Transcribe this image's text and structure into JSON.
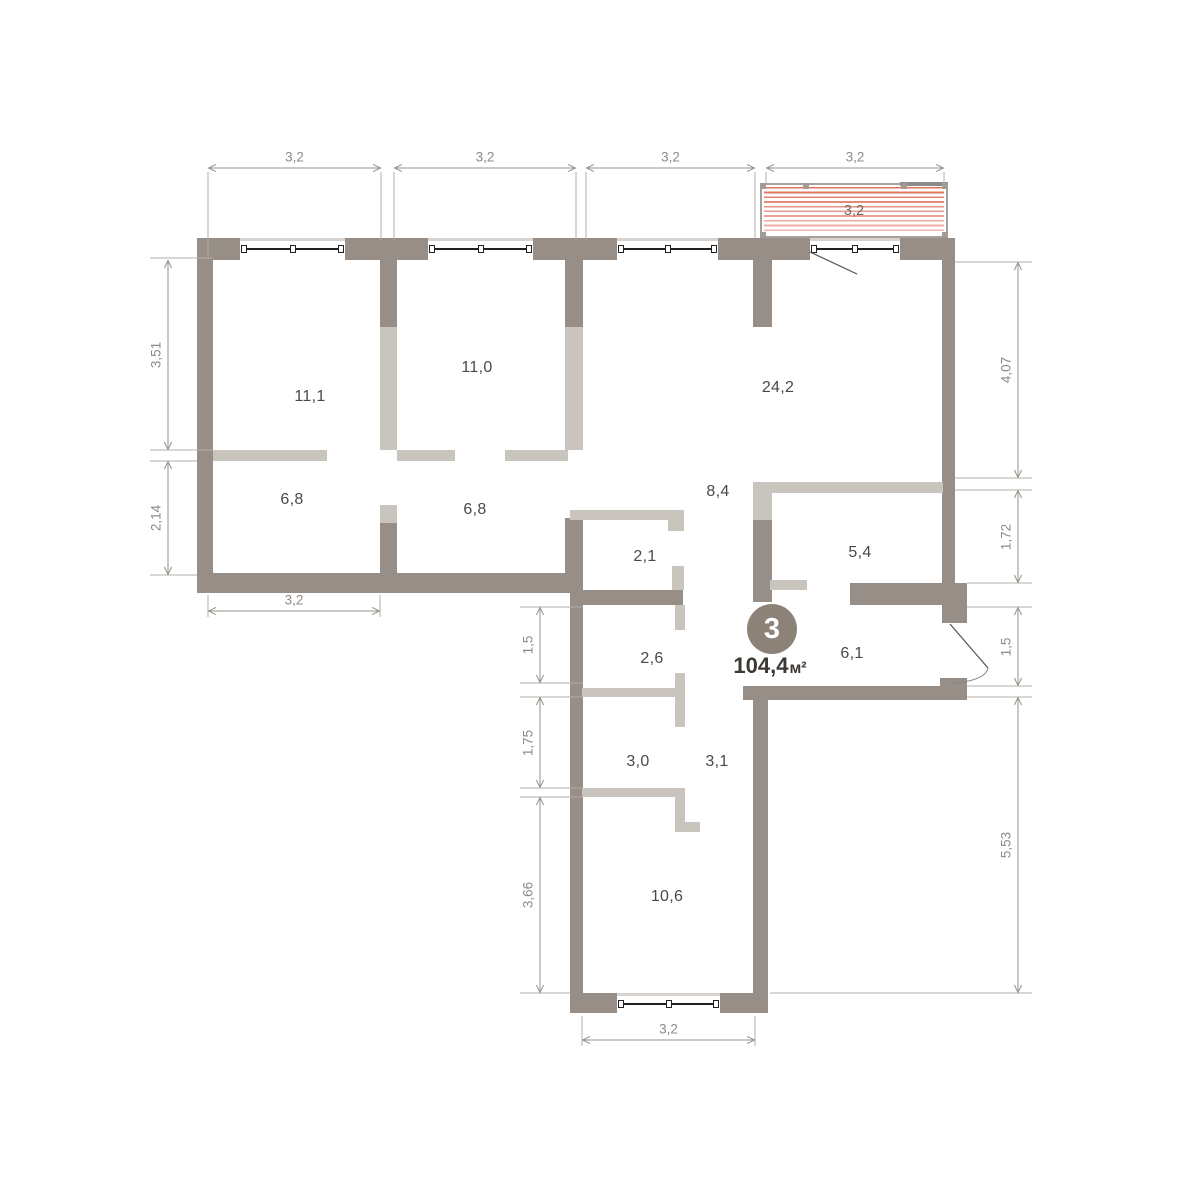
{
  "unit": {
    "badge_number": "3",
    "area_value": "104,4",
    "area_unit": "м²"
  },
  "plan": {
    "canvas": {
      "w": 1177,
      "h": 1200,
      "bg": "#ffffff"
    },
    "colors": {
      "wall_dark": "#978f87",
      "wall_light": "#c9c4be",
      "dim_line": "#97928c",
      "dim_text": "#8f8a84",
      "ext_line": "#b3aea8",
      "room_text": "#4b4945",
      "window_line": "#23211f",
      "balcony_stripe": "#e0705b",
      "balcony_frame": "#a7a19b",
      "badge_fill": "#8c8278",
      "door_line": "#55514d"
    },
    "rooms": [
      {
        "area": "11,1",
        "x": 310,
        "y": 397
      },
      {
        "area": "11,0",
        "x": 477,
        "y": 368
      },
      {
        "area": "24,2",
        "x": 778,
        "y": 388
      },
      {
        "area": "6,8",
        "x": 292,
        "y": 500
      },
      {
        "area": "6,8",
        "x": 475,
        "y": 510
      },
      {
        "area": "8,4",
        "x": 718,
        "y": 492
      },
      {
        "area": "2,1",
        "x": 645,
        "y": 557
      },
      {
        "area": "5,4",
        "x": 860,
        "y": 553
      },
      {
        "area": "2,6",
        "x": 652,
        "y": 659
      },
      {
        "area": "6,1",
        "x": 852,
        "y": 654
      },
      {
        "area": "3,0",
        "x": 638,
        "y": 762
      },
      {
        "area": "3,1",
        "x": 717,
        "y": 762
      },
      {
        "area": "10,6",
        "x": 667,
        "y": 897
      }
    ],
    "walls": [
      {
        "x": 197,
        "y": 238,
        "w": 43,
        "h": 22,
        "tone": "dark"
      },
      {
        "x": 345,
        "y": 238,
        "w": 83,
        "h": 22,
        "tone": "dark"
      },
      {
        "x": 533,
        "y": 238,
        "w": 84,
        "h": 22,
        "tone": "dark"
      },
      {
        "x": 718,
        "y": 238,
        "w": 92,
        "h": 22,
        "tone": "dark"
      },
      {
        "x": 900,
        "y": 238,
        "w": 55,
        "h": 22,
        "tone": "dark"
      },
      {
        "x": 197,
        "y": 260,
        "w": 16,
        "h": 333,
        "tone": "dark"
      },
      {
        "x": 197,
        "y": 573,
        "w": 373,
        "h": 20,
        "tone": "dark"
      },
      {
        "x": 380,
        "y": 260,
        "w": 17,
        "h": 67,
        "tone": "dark"
      },
      {
        "x": 380,
        "y": 523,
        "w": 17,
        "h": 52,
        "tone": "dark"
      },
      {
        "x": 565,
        "y": 260,
        "w": 18,
        "h": 67,
        "tone": "dark"
      },
      {
        "x": 565,
        "y": 518,
        "w": 18,
        "h": 75,
        "tone": "dark"
      },
      {
        "x": 570,
        "y": 585,
        "w": 13,
        "h": 428,
        "tone": "dark"
      },
      {
        "x": 577,
        "y": 590,
        "w": 106,
        "h": 15,
        "tone": "dark"
      },
      {
        "x": 753,
        "y": 238,
        "w": 19,
        "h": 89,
        "tone": "dark"
      },
      {
        "x": 753,
        "y": 520,
        "w": 19,
        "h": 82,
        "tone": "dark"
      },
      {
        "x": 850,
        "y": 583,
        "w": 117,
        "h": 22,
        "tone": "dark"
      },
      {
        "x": 942,
        "y": 260,
        "w": 13,
        "h": 325,
        "tone": "dark"
      },
      {
        "x": 942,
        "y": 605,
        "w": 25,
        "h": 18,
        "tone": "dark"
      },
      {
        "x": 940,
        "y": 678,
        "w": 27,
        "h": 20,
        "tone": "dark"
      },
      {
        "x": 743,
        "y": 686,
        "w": 224,
        "h": 14,
        "tone": "dark"
      },
      {
        "x": 753,
        "y": 700,
        "w": 15,
        "h": 313,
        "tone": "dark"
      },
      {
        "x": 570,
        "y": 993,
        "w": 47,
        "h": 20,
        "tone": "dark"
      },
      {
        "x": 720,
        "y": 993,
        "w": 48,
        "h": 20,
        "tone": "dark"
      },
      {
        "x": 380,
        "y": 327,
        "w": 17,
        "h": 123,
        "tone": "light"
      },
      {
        "x": 380,
        "y": 505,
        "w": 17,
        "h": 18,
        "tone": "light"
      },
      {
        "x": 213,
        "y": 450,
        "w": 114,
        "h": 11,
        "tone": "light"
      },
      {
        "x": 397,
        "y": 450,
        "w": 58,
        "h": 11,
        "tone": "light"
      },
      {
        "x": 505,
        "y": 450,
        "w": 63,
        "h": 11,
        "tone": "light"
      },
      {
        "x": 565,
        "y": 327,
        "w": 18,
        "h": 123,
        "tone": "light"
      },
      {
        "x": 570,
        "y": 510,
        "w": 103,
        "h": 10,
        "tone": "light"
      },
      {
        "x": 668,
        "y": 510,
        "w": 16,
        "h": 21,
        "tone": "light"
      },
      {
        "x": 672,
        "y": 566,
        "w": 12,
        "h": 24,
        "tone": "light"
      },
      {
        "x": 753,
        "y": 482,
        "w": 19,
        "h": 38,
        "tone": "light"
      },
      {
        "x": 763,
        "y": 482,
        "w": 180,
        "h": 11,
        "tone": "light"
      },
      {
        "x": 770,
        "y": 580,
        "w": 37,
        "h": 10,
        "tone": "light"
      },
      {
        "x": 582,
        "y": 688,
        "w": 93,
        "h": 9,
        "tone": "light"
      },
      {
        "x": 675,
        "y": 605,
        "w": 10,
        "h": 25,
        "tone": "light"
      },
      {
        "x": 675,
        "y": 673,
        "w": 10,
        "h": 54,
        "tone": "light"
      },
      {
        "x": 582,
        "y": 788,
        "w": 95,
        "h": 9,
        "tone": "light"
      },
      {
        "x": 675,
        "y": 788,
        "w": 10,
        "h": 42,
        "tone": "light"
      },
      {
        "x": 675,
        "y": 822,
        "w": 25,
        "h": 10,
        "tone": "light"
      }
    ],
    "windows": [
      {
        "x": 240,
        "y": 238,
        "w": 105,
        "h": 22
      },
      {
        "x": 428,
        "y": 238,
        "w": 105,
        "h": 22
      },
      {
        "x": 617,
        "y": 238,
        "w": 101,
        "h": 22
      },
      {
        "x": 810,
        "y": 238,
        "w": 90,
        "h": 22
      },
      {
        "x": 617,
        "y": 993,
        "w": 103,
        "h": 20
      }
    ],
    "balcony": {
      "x": 760,
      "y": 183,
      "w": 188,
      "h": 55,
      "label": "3,2",
      "posts_top": [
        -2,
        41,
        139,
        180
      ],
      "posts_bottom": [
        -2,
        180
      ],
      "rail": {
        "x": 138,
        "y": -3,
        "w": 48
      }
    },
    "dims": [
      {
        "value": "3,2",
        "orient": "h",
        "x1": 208,
        "x2": 381,
        "y": 168
      },
      {
        "value": "3,2",
        "orient": "h",
        "x1": 394,
        "x2": 576,
        "y": 168
      },
      {
        "value": "3,2",
        "orient": "h",
        "x1": 586,
        "x2": 755,
        "y": 168
      },
      {
        "value": "3,2",
        "orient": "h",
        "x1": 766,
        "x2": 944,
        "y": 168
      },
      {
        "value": "3,51",
        "orient": "v",
        "y1": 260,
        "y2": 450,
        "x": 168
      },
      {
        "value": "2,14",
        "orient": "v",
        "y1": 461,
        "y2": 575,
        "x": 168
      },
      {
        "value": "3,2",
        "orient": "h",
        "x1": 208,
        "x2": 380,
        "y": 611
      },
      {
        "value": "1,5",
        "orient": "v",
        "y1": 607,
        "y2": 683,
        "x": 540
      },
      {
        "value": "1,75",
        "orient": "v",
        "y1": 697,
        "y2": 788,
        "x": 540
      },
      {
        "value": "3,66",
        "orient": "v",
        "y1": 797,
        "y2": 993,
        "x": 540
      },
      {
        "value": "3,2",
        "orient": "h",
        "x1": 582,
        "x2": 755,
        "y": 1040
      },
      {
        "value": "4,07",
        "orient": "v",
        "y1": 262,
        "y2": 478,
        "x": 1018
      },
      {
        "value": "1,72",
        "orient": "v",
        "y1": 490,
        "y2": 583,
        "x": 1018
      },
      {
        "value": "1,5",
        "orient": "v",
        "y1": 607,
        "y2": 686,
        "x": 1018
      },
      {
        "value": "5,53",
        "orient": "v",
        "y1": 697,
        "y2": 993,
        "x": 1018
      }
    ],
    "ext_lines": [
      [
        150,
        258,
        213,
        258
      ],
      [
        150,
        450,
        213,
        450
      ],
      [
        150,
        461,
        197,
        461
      ],
      [
        150,
        575,
        197,
        575
      ],
      [
        208,
        172,
        208,
        258
      ],
      [
        381,
        172,
        381,
        240
      ],
      [
        394,
        172,
        394,
        240
      ],
      [
        576,
        172,
        576,
        240
      ],
      [
        586,
        172,
        586,
        240
      ],
      [
        755,
        172,
        755,
        238
      ],
      [
        766,
        172,
        766,
        184
      ],
      [
        944,
        172,
        944,
        184
      ],
      [
        208,
        595,
        208,
        617
      ],
      [
        380,
        595,
        380,
        617
      ],
      [
        520,
        607,
        583,
        607
      ],
      [
        520,
        683,
        583,
        683
      ],
      [
        520,
        697,
        583,
        697
      ],
      [
        520,
        788,
        583,
        788
      ],
      [
        520,
        797,
        583,
        797
      ],
      [
        520,
        993,
        570,
        993
      ],
      [
        582,
        1016,
        582,
        1046
      ],
      [
        755,
        1016,
        755,
        1046
      ],
      [
        955,
        262,
        1032,
        262
      ],
      [
        955,
        478,
        1032,
        478
      ],
      [
        955,
        490,
        1032,
        490
      ],
      [
        967,
        583,
        1032,
        583
      ],
      [
        967,
        607,
        1032,
        607
      ],
      [
        967,
        686,
        1032,
        686
      ],
      [
        967,
        697,
        1032,
        697
      ],
      [
        770,
        993,
        1032,
        993
      ]
    ],
    "door_lines": [
      {
        "name": "balcony-door-swing",
        "x1": 810,
        "y1": 252,
        "x2": 857,
        "y2": 274
      },
      {
        "name": "entry-door-leaf",
        "x1": 950,
        "y1": 624,
        "x2": 988,
        "y2": 668
      }
    ],
    "door_arcs": [
      {
        "name": "entry-door-arc",
        "d": "M988,668 Q985,681 952,683"
      }
    ]
  }
}
